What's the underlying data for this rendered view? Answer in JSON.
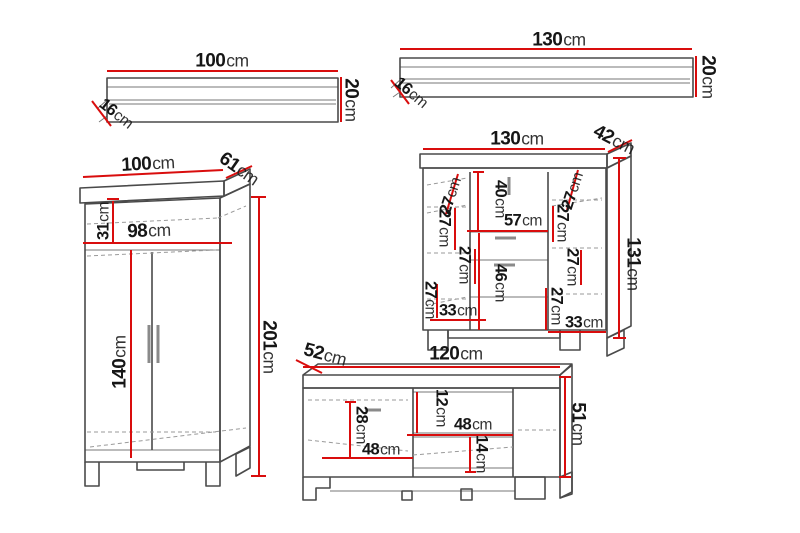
{
  "colors": {
    "dimension_line": "#d90d0d",
    "outline": "#4a4a4a",
    "hidden_line": "#9a9a9a",
    "text": "#161616"
  },
  "shelf_small": {
    "width": {
      "value": "100",
      "unit": "cm"
    },
    "height": {
      "value": "20",
      "unit": "cm"
    },
    "depth": {
      "value": "16",
      "unit": "cm"
    }
  },
  "shelf_large": {
    "width": {
      "value": "130",
      "unit": "cm"
    },
    "height": {
      "value": "20",
      "unit": "cm"
    },
    "depth": {
      "value": "16",
      "unit": "cm"
    }
  },
  "wardrobe": {
    "width": {
      "value": "100",
      "unit": "cm"
    },
    "depth": {
      "value": "61",
      "unit": "cm"
    },
    "height": {
      "value": "201",
      "unit": "cm"
    },
    "top_shelf_height": {
      "value": "31",
      "unit": "cm"
    },
    "interior_width": {
      "value": "98",
      "unit": "cm"
    },
    "door_height": {
      "value": "140",
      "unit": "cm"
    }
  },
  "sideboard": {
    "width": {
      "value": "130",
      "unit": "cm"
    },
    "depth": {
      "value": "42",
      "unit": "cm"
    },
    "height": {
      "value": "131",
      "unit": "cm"
    },
    "center_opening_height": {
      "value": "40",
      "unit": "cm"
    },
    "center_width": {
      "value": "57",
      "unit": "cm"
    },
    "lower_opening_height": {
      "value": "46",
      "unit": "cm"
    },
    "left_compartment_width": {
      "value": "33",
      "unit": "cm"
    },
    "right_compartment_width": {
      "value": "33",
      "unit": "cm"
    },
    "left_spacings": [
      {
        "value": "27",
        "unit": "cm"
      },
      {
        "value": "27",
        "unit": "cm"
      },
      {
        "value": "27",
        "unit": "cm"
      },
      {
        "value": "27",
        "unit": "cm"
      }
    ],
    "right_spacings": [
      {
        "value": "27",
        "unit": "cm"
      },
      {
        "value": "27",
        "unit": "cm"
      },
      {
        "value": "27",
        "unit": "cm"
      },
      {
        "value": "27",
        "unit": "cm"
      }
    ]
  },
  "tv_stand": {
    "width": {
      "value": "120",
      "unit": "cm"
    },
    "depth": {
      "value": "52",
      "unit": "cm"
    },
    "height": {
      "value": "51",
      "unit": "cm"
    },
    "left_opening_height": {
      "value": "28",
      "unit": "cm"
    },
    "left_opening_width": {
      "value": "48",
      "unit": "cm"
    },
    "upper_shelf_height": {
      "value": "12",
      "unit": "cm"
    },
    "niche_width": {
      "value": "48",
      "unit": "cm"
    },
    "lower_shelf_height": {
      "value": "14",
      "unit": "cm"
    }
  }
}
